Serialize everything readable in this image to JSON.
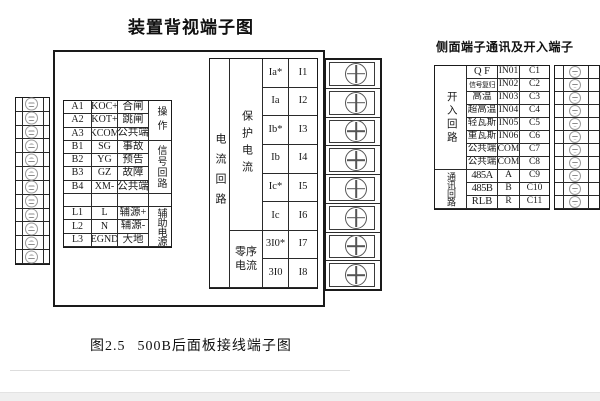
{
  "page": {
    "main_title": "装置背视端子图",
    "side_title": "侧面端子通讯及开入端子",
    "caption_no": "图2.5",
    "caption_text": "500B后面板接线端子图"
  },
  "left_table": {
    "rows": [
      [
        "A1",
        "KOC+",
        "合闸"
      ],
      [
        "A2",
        "KOT+",
        "跳闸"
      ],
      [
        "A3",
        "KCOM",
        "公共端"
      ],
      [
        "B1",
        "SG",
        "事故"
      ],
      [
        "B2",
        "YG",
        "预告"
      ],
      [
        "B3",
        "GZ",
        "故障"
      ],
      [
        "B4",
        "XM-",
        "公共端"
      ],
      [
        "",
        "",
        ""
      ],
      [
        "L1",
        "L",
        "辅源+"
      ],
      [
        "L2",
        "N",
        "辅源-"
      ],
      [
        "L3",
        "EGND",
        "大地"
      ]
    ],
    "groups": [
      {
        "label": "操作",
        "span": 3
      },
      {
        "label": "信号回路",
        "span": 4
      },
      {
        "label": "",
        "span": 1
      },
      {
        "label": "辅助电源",
        "span": 3
      }
    ]
  },
  "current_table": {
    "circuit_label": "电流回路",
    "groups": [
      {
        "label": "保护电流",
        "span": 6
      },
      {
        "label": "零序电流",
        "span": 2
      }
    ],
    "rows": [
      [
        "Ia*",
        "I1"
      ],
      [
        "Ia",
        "I2"
      ],
      [
        "Ib*",
        "I3"
      ],
      [
        "Ib",
        "I4"
      ],
      [
        "Ic*",
        "I5"
      ],
      [
        "Ic",
        "I6"
      ],
      [
        "3I0*",
        "I7"
      ],
      [
        "3I0",
        "I8"
      ]
    ]
  },
  "side_table": {
    "groups": [
      {
        "label": "开入回路",
        "span": 8
      },
      {
        "label": "通讯回路",
        "span": 3
      }
    ],
    "rows": [
      [
        "Q F",
        "IN01",
        "C1"
      ],
      [
        "信号复归",
        "IN02",
        "C2"
      ],
      [
        "高温",
        "IN03",
        "C3"
      ],
      [
        "超高温",
        "IN04",
        "C4"
      ],
      [
        "轻瓦斯",
        "IN05",
        "C5"
      ],
      [
        "重瓦斯",
        "IN06",
        "C6"
      ],
      [
        "公共端",
        "COM",
        "C7"
      ],
      [
        "公共端",
        "COM",
        "C8"
      ],
      [
        "485A",
        "A",
        "C9"
      ],
      [
        "485B",
        "B",
        "C10"
      ],
      [
        "RLB",
        "R",
        "C11"
      ]
    ]
  },
  "strips": {
    "left": {
      "rows": 12,
      "type": "slot"
    },
    "middle": {
      "rows": 8,
      "type": "cross"
    },
    "right": {
      "rows": 11,
      "type": "slot"
    }
  },
  "colors": {
    "line": "#1a1a1a",
    "screw_gray": "#8d8d8d",
    "bottom_bar": "#efefef"
  }
}
